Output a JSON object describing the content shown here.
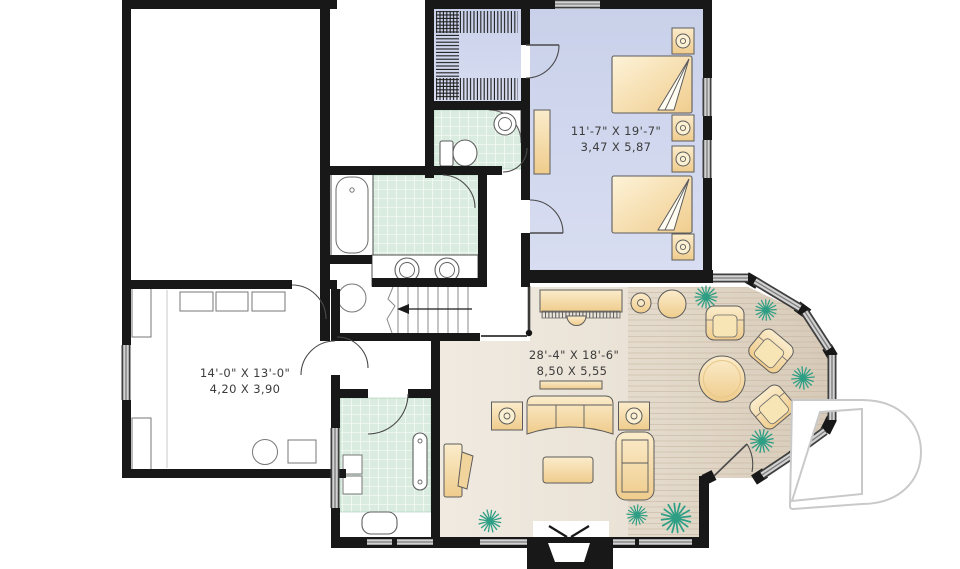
{
  "rooms": {
    "bedroom": {
      "imperial": "11'-7\" X 19'-7\"",
      "metric": "3,47 X 5,87"
    },
    "laundry": {
      "imperial": "14'-0\" X 13'-0\"",
      "metric": "4,20 X 3,90"
    },
    "family": {
      "imperial": "28'-4\" X 18'-6\"",
      "metric": "8,50 X 5,55"
    }
  },
  "logo": {
    "letter": "D"
  },
  "colors": {
    "wall": "#181818",
    "bedroom_floor": "#cfd6ed",
    "bath_tile": "#d9ecdf",
    "living_floor": "#ebe3d7",
    "furniture_tan": "#f2d49b",
    "plant_green": "#2e9f85",
    "window_gray": "#d2d2d2",
    "logo_gray": "#c9c9c9"
  }
}
